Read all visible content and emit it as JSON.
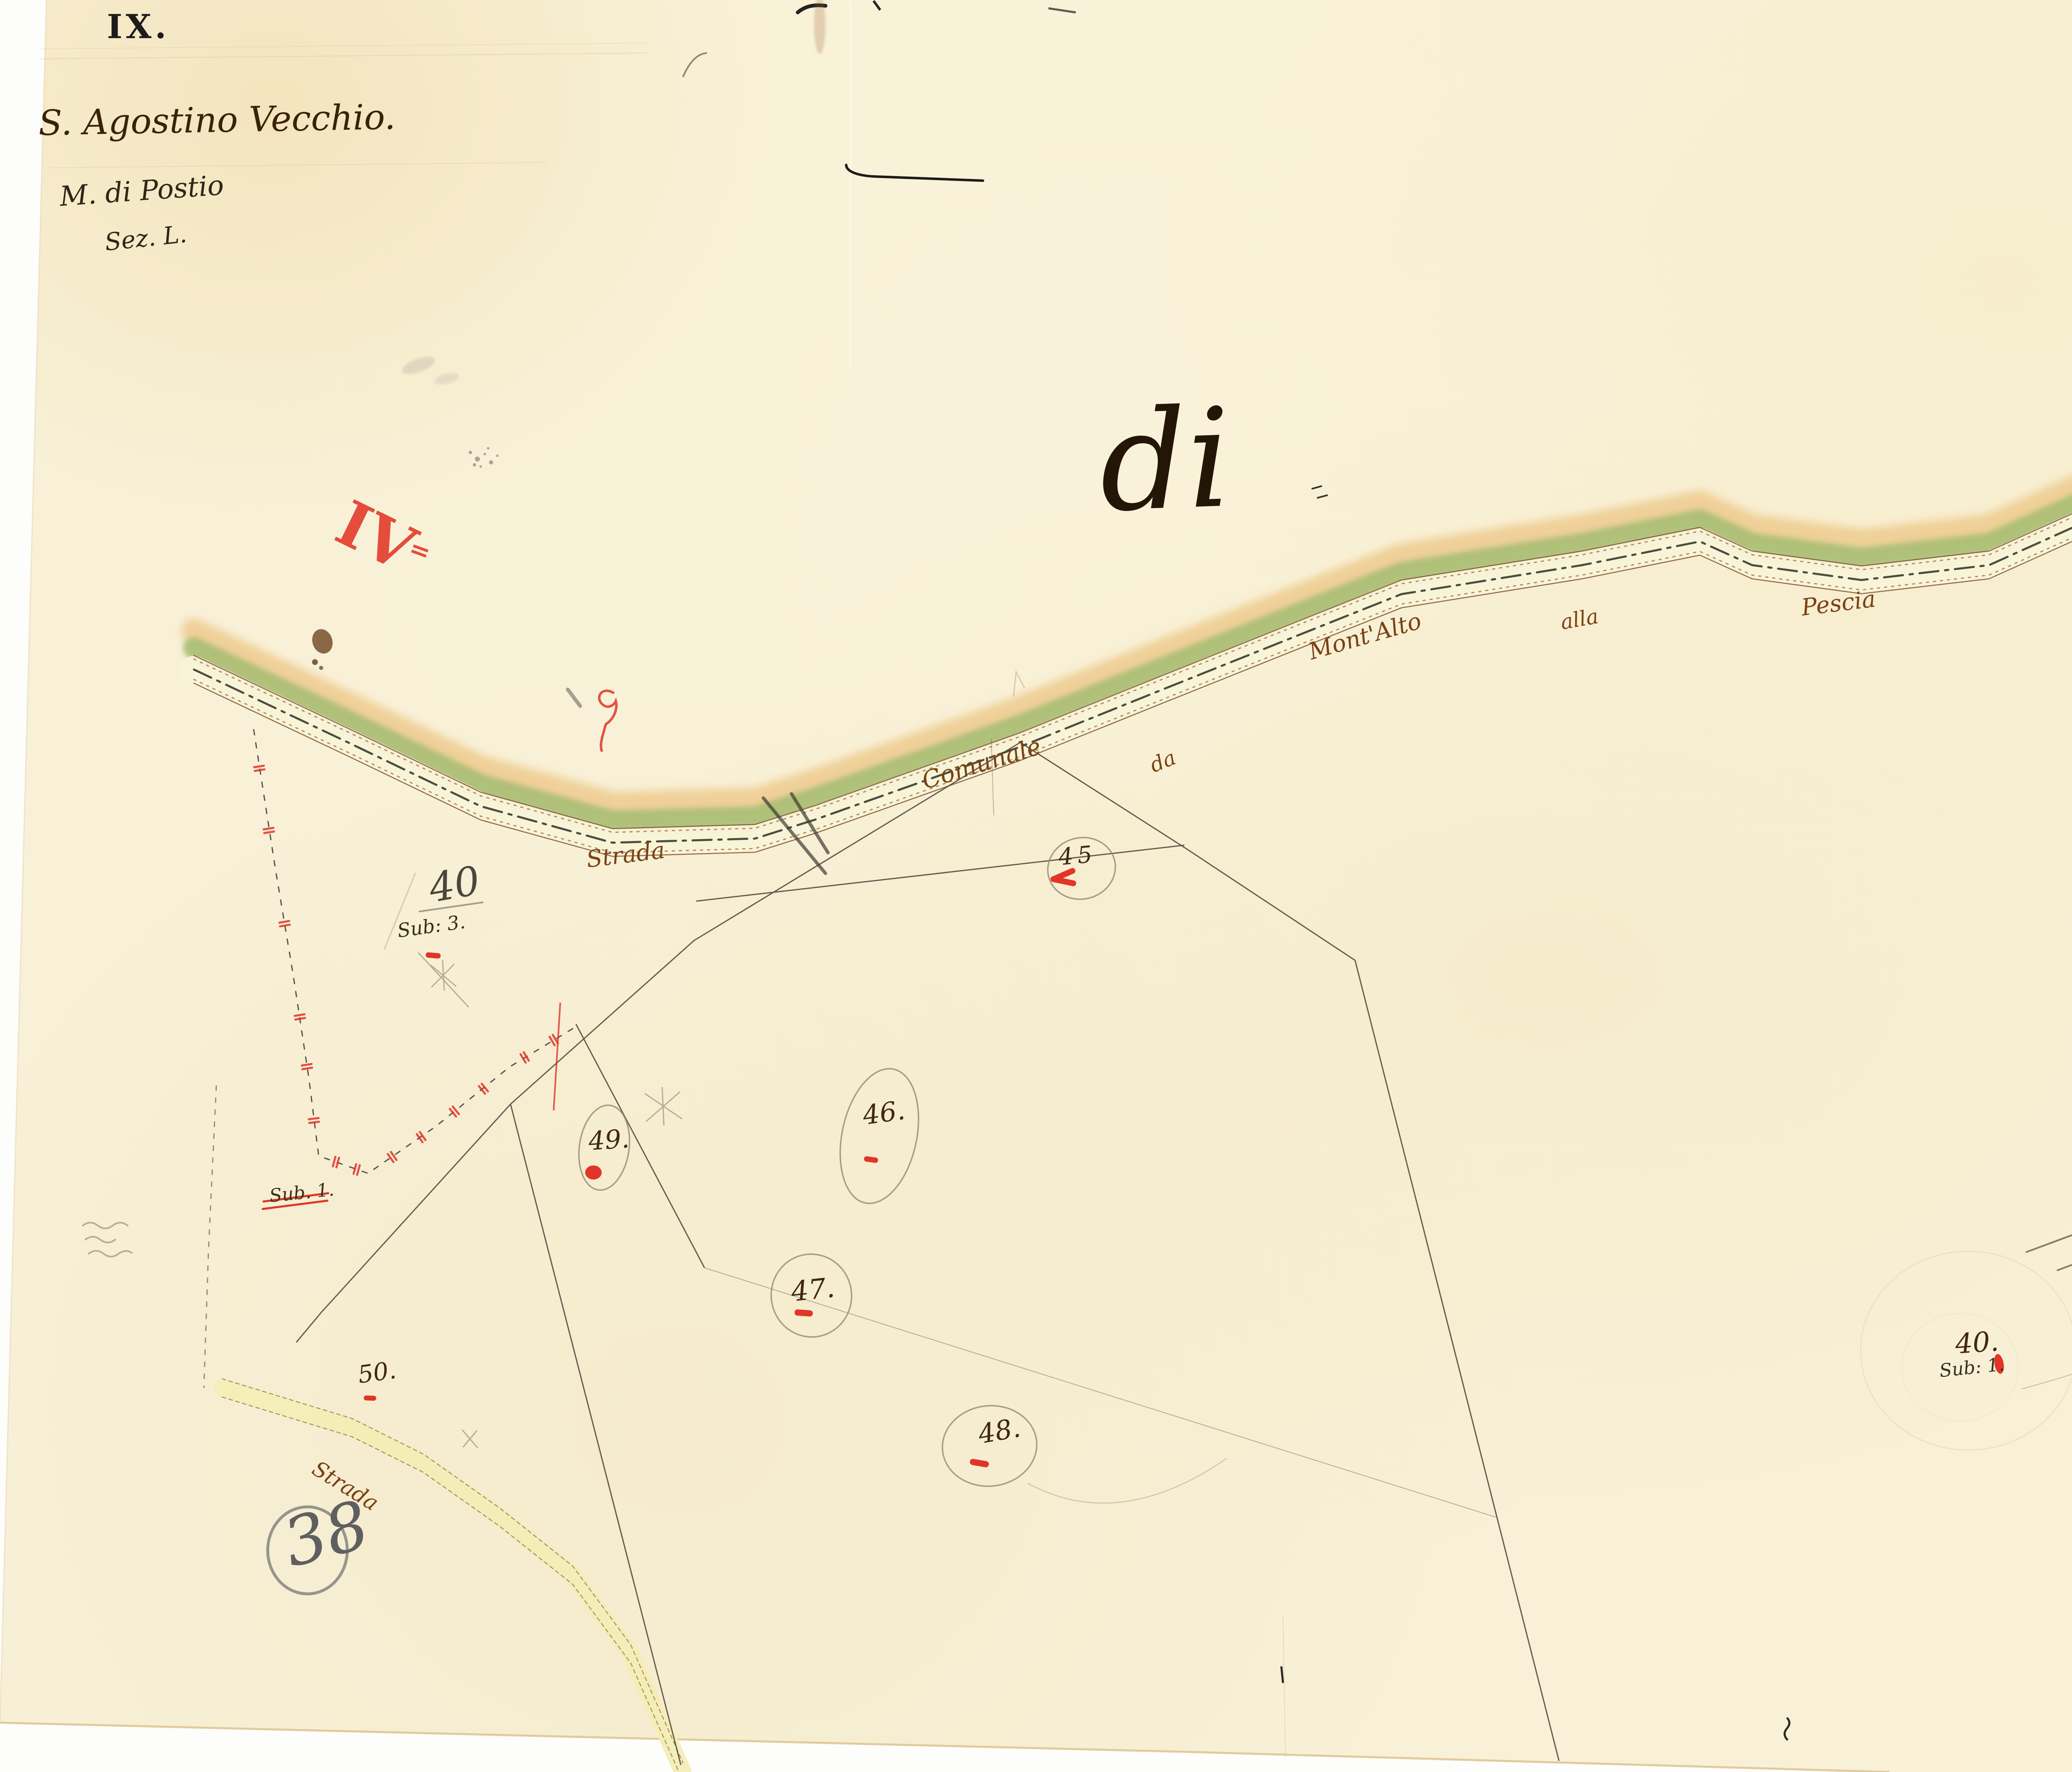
{
  "page": {
    "sheet_number": "IX.",
    "territory_title": "S. Agostino Vecchio.",
    "territory_subtitle": "M. di Postio",
    "section_label": "Sez. L.",
    "large_script_word": "di",
    "red_section_numeral": "IV",
    "red_section_suffix": "=",
    "red_letter_mark": "B",
    "adjacent_sheet_number": "38"
  },
  "main_road": {
    "full_name": "Strada Comunale da Mont'Alto alla Pescia",
    "words": {
      "strada": "Strada",
      "comunale": "Comunale",
      "da": "da",
      "montalto": "Mont'Alto",
      "alla": "alla",
      "pescia": "Pescia"
    }
  },
  "secondary_road": {
    "label": "Strada"
  },
  "parcels": {
    "p45": {
      "label": "45"
    },
    "p46": {
      "label": "46."
    },
    "p47": {
      "label": "47."
    },
    "p48": {
      "label": "48."
    },
    "p49": {
      "label": "49."
    },
    "p50": {
      "label": "50."
    },
    "p40_sub3": {
      "label": "40",
      "sub": "Sub: 3."
    },
    "p40_sub1": {
      "label": "40.",
      "sub": "Sub: 1."
    }
  },
  "annotations": {
    "struck_label": "Sub. 1."
  },
  "colors": {
    "paper": "#f8f1d8",
    "road_green": "#a9bd72",
    "road_tan": "#eecb8e",
    "road_bed": "#f8f3d8",
    "secondary_road_fill": "#f3edb6",
    "ink_road_label": "#7a4214",
    "ink_parcel": "#3f2812",
    "ink_dark": "#241607",
    "red_mark": "#e03528",
    "pencil": "#8b8172"
  }
}
